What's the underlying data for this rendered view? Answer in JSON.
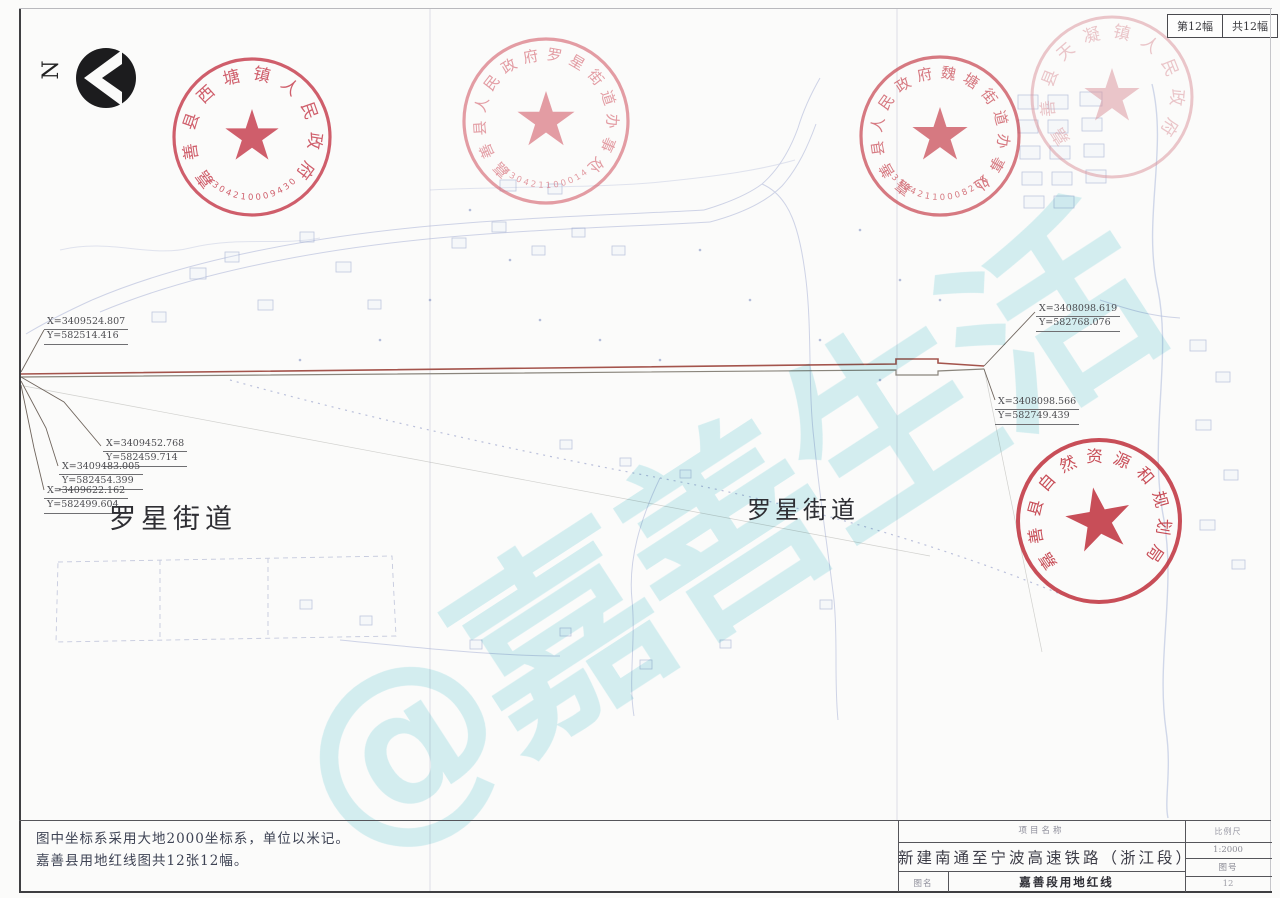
{
  "sheet_badge": {
    "left": "第12幅",
    "right": "共12幅"
  },
  "north": {
    "label": "N"
  },
  "watermark": {
    "text": "@嘉善生活",
    "color": "#cdeef2"
  },
  "seals": [
    {
      "id": "xitang",
      "text": "嘉善县西塘镇人民政府",
      "number": "3304210009430",
      "color": "#c53848"
    },
    {
      "id": "luoxing",
      "text": "嘉善县人民政府罗星街道办事处",
      "number": "330421100014",
      "color": "#d4626e"
    },
    {
      "id": "weitang",
      "text": "嘉善县人民政府魏塘街道办事处",
      "number": "33042110008268",
      "color": "#c84752"
    },
    {
      "id": "tianning",
      "text": "嘉善县天凝镇人民政府",
      "number": "",
      "color": "#d98f97"
    },
    {
      "id": "ziranziyuan",
      "text": "嘉善县自然资源和规划局",
      "number": "",
      "color": "#bf2f3b"
    }
  ],
  "coordinates": [
    {
      "x": "X=3409524.807",
      "y": "Y=582514.416"
    },
    {
      "x": "X=3409452.768",
      "y": "Y=582459.714"
    },
    {
      "x": "X=3409483.005",
      "y": "Y=582454.399"
    },
    {
      "x": "X=3409622.162",
      "y": "Y=582499.604"
    },
    {
      "x": "X=3408098.619",
      "y": "Y=582768.076"
    },
    {
      "x": "X=3408098.566",
      "y": "Y=582749.439"
    }
  ],
  "districts": [
    "罗星街道",
    "罗星街道"
  ],
  "notes": [
    "图中坐标系采用大地2000坐标系，单位以米记。",
    "嘉善县用地红线图共12张12幅。"
  ],
  "title_block": {
    "project_label": "项目名称",
    "project_name": "新建南通至宁波高速铁路（浙江段）",
    "drawing_label": "图名",
    "drawing_name": "嘉善段用地红线",
    "scale_label": "比例尺",
    "scale_value": "1:2000",
    "sheet_no_label": "图号",
    "sheet_no_value": "12"
  },
  "colors": {
    "seal_red": "#c53848",
    "route_line": "#a4544c",
    "map_linework": "#a9b2d6",
    "watermark": "#cdeef2",
    "paper": "#fbfbfa"
  }
}
